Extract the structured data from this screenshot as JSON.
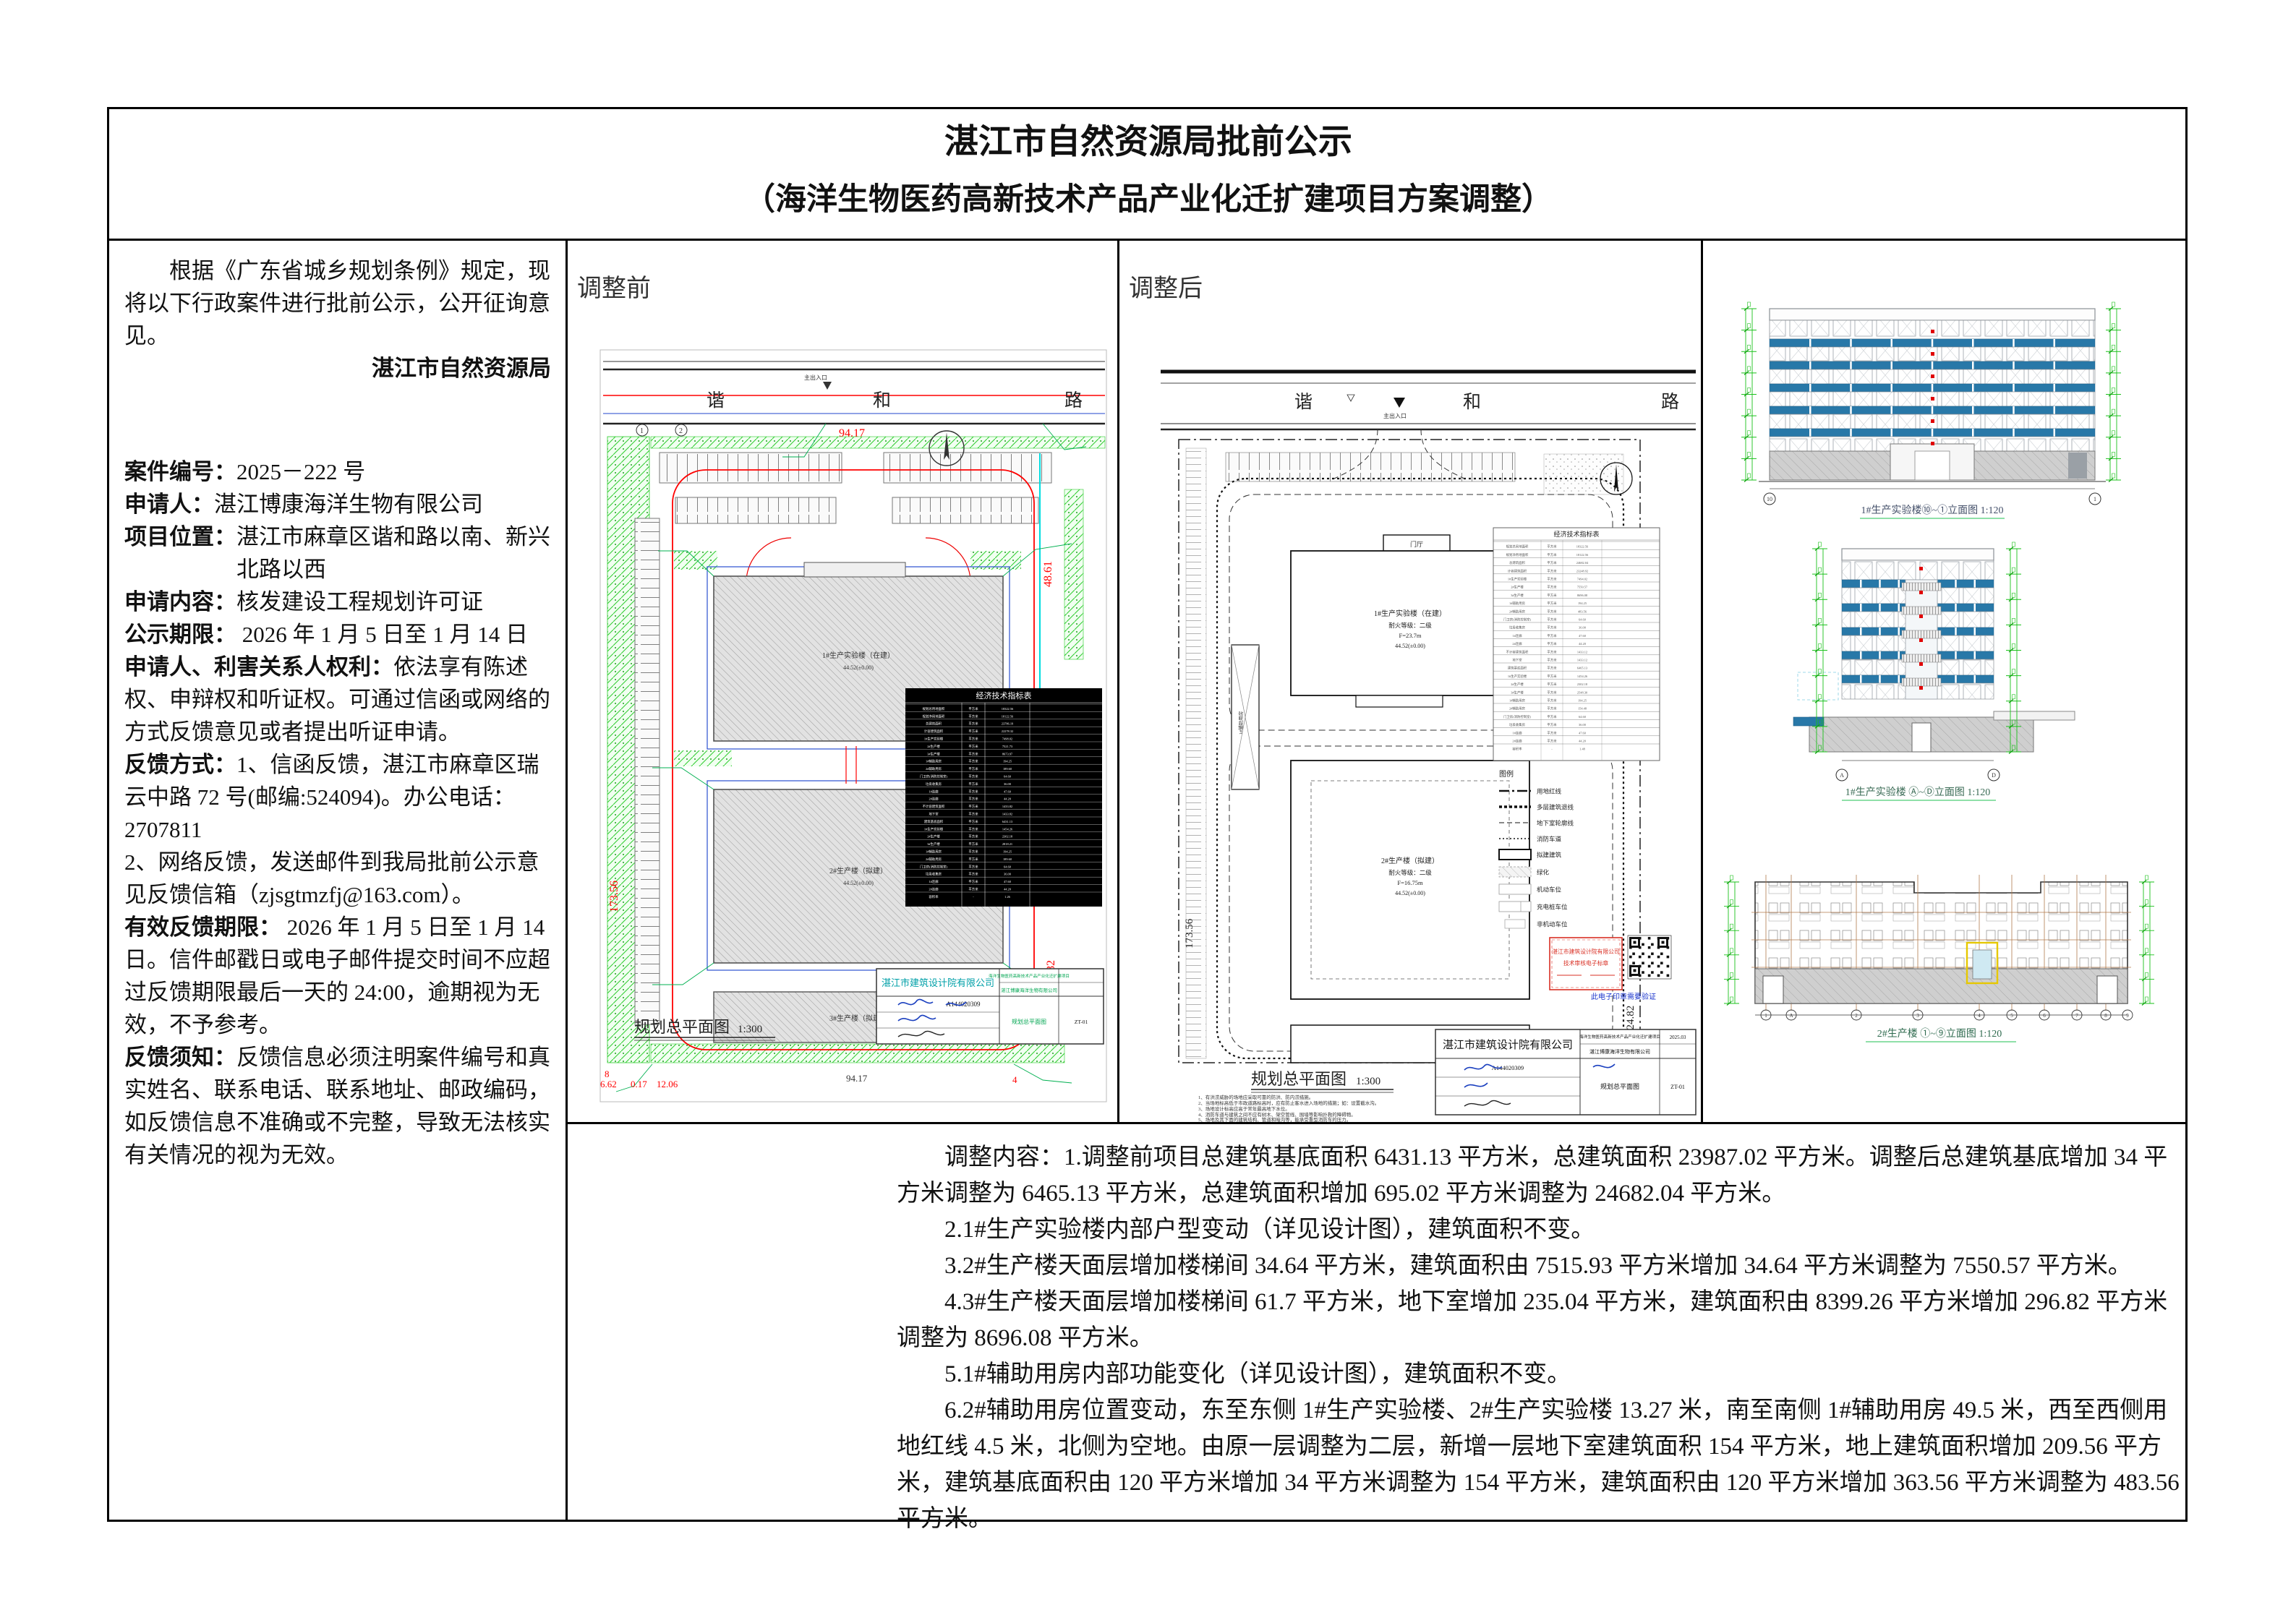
{
  "page": {
    "title_line1": "湛江市自然资源局批前公示",
    "title_line2": "（海洋生物医药高新技术产品产业化迁扩建项目方案调整）"
  },
  "left_column": {
    "intro": "根据《广东省城乡规划条例》规定，现将以下行政案件进行批前公示，公开征询意见。",
    "authority": "湛江市自然资源局",
    "fields": [
      {
        "label": "案件编号：",
        "value": "2025－222 号"
      },
      {
        "label": "申请人：",
        "value": "湛江博康海洋生物有限公司"
      },
      {
        "label": "项目位置：",
        "value": "湛江市麻章区谐和路以南、新兴北路以西"
      },
      {
        "label": "申请内容：",
        "value": "核发建设工程规划许可证"
      },
      {
        "label": "公示期限：",
        "value": " 2026 年 1 月 5 日至 1 月 14 日"
      },
      {
        "label": "申请人、利害关系人权利：",
        "value": "依法享有陈述权、申辩权和听证权。可通过信函或网络的方式反馈意见或者提出听证申请。"
      },
      {
        "label": "反馈方式：",
        "value": "1、信函反馈，湛江市麻章区瑞云中路 72 号(邮编:524094)。办公电话： 2707811"
      },
      {
        "label": "",
        "value": "2、网络反馈，发送邮件到我局批前公示意见反馈信箱（zjsgtmzfj@163.com）。"
      },
      {
        "label": "有效反馈期限：",
        "value": " 2026 年 1 月 5 日至 1 月 14 日。信件邮戳日或电子邮件提交时间不应超过反馈期限最后一天的 24:00，逾期视为无效，不予参考。"
      },
      {
        "label": "反馈须知：",
        "value": "反馈信息必须注明案件编号和真实姓名、联系电话、联系地址、邮政编码，如反馈信息不准确或不完整，导致无法核实有关情况的视为无效。"
      }
    ]
  },
  "before_panel": {
    "label": "调整前",
    "road_chars": [
      "谐",
      "和",
      "路"
    ],
    "entrance": "主出入口",
    "dims": {
      "top": "94.17",
      "right_upper": "48.61",
      "left": "173.56",
      "right_lower": "124.82",
      "bottom": "94.17",
      "bottom_left_a": "8",
      "bottom_left_b": "6.62",
      "bottom_left_c": "0.17",
      "bottom_left_d": "12.06",
      "corner": "4",
      "axis1": "1",
      "axis2": "2"
    },
    "buildings": [
      "1#生产实验楼（在建）",
      "2#生产楼（拟建）",
      "3#生产楼（拟建）"
    ],
    "level_note": "44.52(±0.00)",
    "table": {
      "title": "经济技术指标表",
      "unit": "平方米",
      "labels": [
        "规划总用地面积",
        "规划净用地面积",
        "总建筑面积",
        "计容建筑面积",
        "1#生产实验楼",
        "2#生产楼",
        "3#生产楼",
        "1#辅助用房",
        "2#辅助用房",
        "门卫房(消防控制室)",
        "垃圾收集房",
        "1#连廊",
        "2#连廊",
        "不计容建筑面积",
        "地下室",
        "建筑基底面积",
        "1#生产实验楼",
        "2#生产楼",
        "3#生产楼",
        "1#辅助用房",
        "2#辅助用房",
        "门卫房(消防控制室)",
        "垃圾收集房",
        "1#连廊",
        "2#连廊",
        "容积率"
      ],
      "values": [
        "18322.56",
        "18122.56",
        "23786.19",
        "22278.32",
        "7498.02",
        "7521.73",
        "8673.97",
        "194.25",
        "189.60",
        "64.60",
        "36.00",
        "47.60",
        "44.20",
        "1433.82",
        "1433.82",
        "6431.13",
        "1454.26",
        "2302.18",
        "2818.21",
        "194.25",
        "189.60",
        "64.60",
        "36.00",
        "47.60",
        "44.20",
        "1.26"
      ]
    },
    "plan_label": "规划总平面图",
    "plan_scale": "1:300",
    "titleblock": {
      "company": "湛江市建筑设计院有限公司",
      "cert_no": "A144020309",
      "project": "海洋生物医药高新技术产品产业化迁扩建项目",
      "owner": "湛江博康海洋生物有限公司",
      "drawing": "规划总平面图",
      "sheet": "ZT-01"
    }
  },
  "after_panel": {
    "label": "调整后",
    "road_chars": [
      "谐",
      "和",
      "路"
    ],
    "entrance": "主出入口",
    "dims": {
      "left": "173.56",
      "right": "124.82"
    },
    "buildings": {
      "b1_name": "1#生产实验楼（在建）",
      "b1_fire": "耐火等级：二级",
      "b1_height": "F=23.7m",
      "b1_level": "44.52(±0.00)",
      "b1_lobby": "门厅",
      "b2_name": "2#生产楼（拟建）",
      "b2_fire": "耐火等级：二级",
      "b2_height": "F=16.75m",
      "b2_level": "44.52(±0.00)",
      "aux_name": "1#辅助用房"
    },
    "table": {
      "title": "经济技术指标表",
      "unit": "平方米",
      "labels": [
        "规划总用地面积",
        "规划净用地面积",
        "总建筑面积",
        "计容建筑面积",
        "1#生产实验楼",
        "2#生产楼",
        "3#生产楼",
        "1#辅助用房",
        "2#辅助用房",
        "门卫房(消防控制室)",
        "垃圾收集房",
        "1#连廊",
        "2#连廊",
        "不计容建筑面积",
        "地下室",
        "建筑基底面积",
        "1#生产实验楼",
        "2#生产楼",
        "3#生产楼",
        "1#辅助用房",
        "2#辅助用房",
        "门卫房(消防控制室)",
        "垃圾收集房",
        "1#连廊",
        "2#连廊",
        "容积率"
      ],
      "values": [
        "18322.56",
        "18122.56",
        "24682.04",
        "23248.92",
        "7494.02",
        "7550.57",
        "8696.08",
        "194.25",
        "483.56",
        "64.60",
        "36.00",
        "47.60",
        "44.20",
        "1433.12",
        "1433.12",
        "6465.13",
        "1454.26",
        "2302.18",
        "2548.30",
        "194.25",
        "154.48",
        "64.60",
        "36.00",
        "47.60",
        "44.20",
        "1.48"
      ]
    },
    "legend": {
      "title": "图例",
      "items": [
        "用地红线",
        "多层建筑退线",
        "地下室轮廓线",
        "消防车道",
        "拟建建筑",
        "绿化",
        "机动车位",
        "充电桩车位",
        "非机动车位"
      ]
    },
    "stamp": {
      "line1": "湛江市建筑设计院有限公司",
      "line2": "技术审核电子标章",
      "caption": "此电子印章需要验证"
    },
    "plan_label": "规划总平面图",
    "plan_scale": "1:300",
    "notes": [
      "1、有洪涝威胁的场地应采取可靠的防洪、防内涝措施。",
      "2、当场地标高低于市政道路标高时，应有防止客水进入场地的措施；如：设置截水沟。",
      "3、场地设计标高应高于常年最高地下水位。",
      "4、消防车道与建筑之间不应有树木、架空管线、围墙等影响扑救的障碍物。",
      "5、场地及其下面的建筑结构、管道和暗沟等，能承受重型消防车的压力。"
    ],
    "titleblock": {
      "company": "湛江市建筑设计院有限公司",
      "cert_no": "A144020309",
      "project": "海洋生物医药高新技术产品产业化迁扩建项目",
      "date": "2025.03",
      "owner": "湛江博康海洋生物有限公司",
      "drawing": "规划总平面图",
      "sheet": "ZT-01"
    }
  },
  "elevations": {
    "e1": {
      "label": "1#生产实验楼⑩~①立面图 1:120",
      "axis_left": "10",
      "axis_right": "1"
    },
    "e2": {
      "label": "1#生产实验楼 Ⓐ~Ⓓ立面图 1:120",
      "axis_left": "A",
      "axis_right": "D"
    },
    "e3": {
      "label": "2#生产楼 ①~⑨立面图 1:120",
      "axes": [
        "1",
        "A",
        "2",
        "3",
        "4",
        "5",
        "6",
        "7",
        "8",
        "9"
      ]
    }
  },
  "adjustment": {
    "paragraphs": [
      "调整内容：1.调整前项目总建筑基底面积 6431.13 平方米，总建筑面积 23987.02 平方米。调整后总建筑基底增加 34 平方米调整为 6465.13 平方米，总建筑面积增加 695.02 平方米调整为 24682.04 平方米。",
      "2.1#生产实验楼内部户型变动（详见设计图），建筑面积不变。",
      "3.2#生产楼天面层增加楼梯间 34.64 平方米，建筑面积由 7515.93 平方米增加 34.64 平方米调整为 7550.57 平方米。",
      "4.3#生产楼天面层增加楼梯间 61.7 平方米，地下室增加 235.04 平方米，建筑面积由 8399.26 平方米增加 296.82 平方米调整为 8696.08 平方米。",
      "5.1#辅助用房内部功能变化（详见设计图），建筑面积不变。",
      "6.2#辅助用房位置变动，东至东侧 1#生产实验楼、2#生产实验楼 13.27 米，南至南侧 1#辅助用房 49.5 米，西至西侧用地红线 4.5 米，北侧为空地。由原一层调整为二层，新增一层地下室建筑面积 154 平方米，地上建筑面积增加 209.56 平方米，建筑基底面积由 120 平方米增加 34 平方米调整为 154 平方米，建筑面积由 120 平方米增加 363.56 平方米调整为 483.56 平方米。"
    ]
  },
  "colors": {
    "band_blue": "#2878a8",
    "annot_green": "#00b050",
    "line_red": "#ff0000",
    "setback_blue": "#2a4fd0",
    "cyan": "#00dde0",
    "stamp_red": "#d93025",
    "sign_blue": "#1a3fbf",
    "teal_company": "#00a0a8"
  }
}
